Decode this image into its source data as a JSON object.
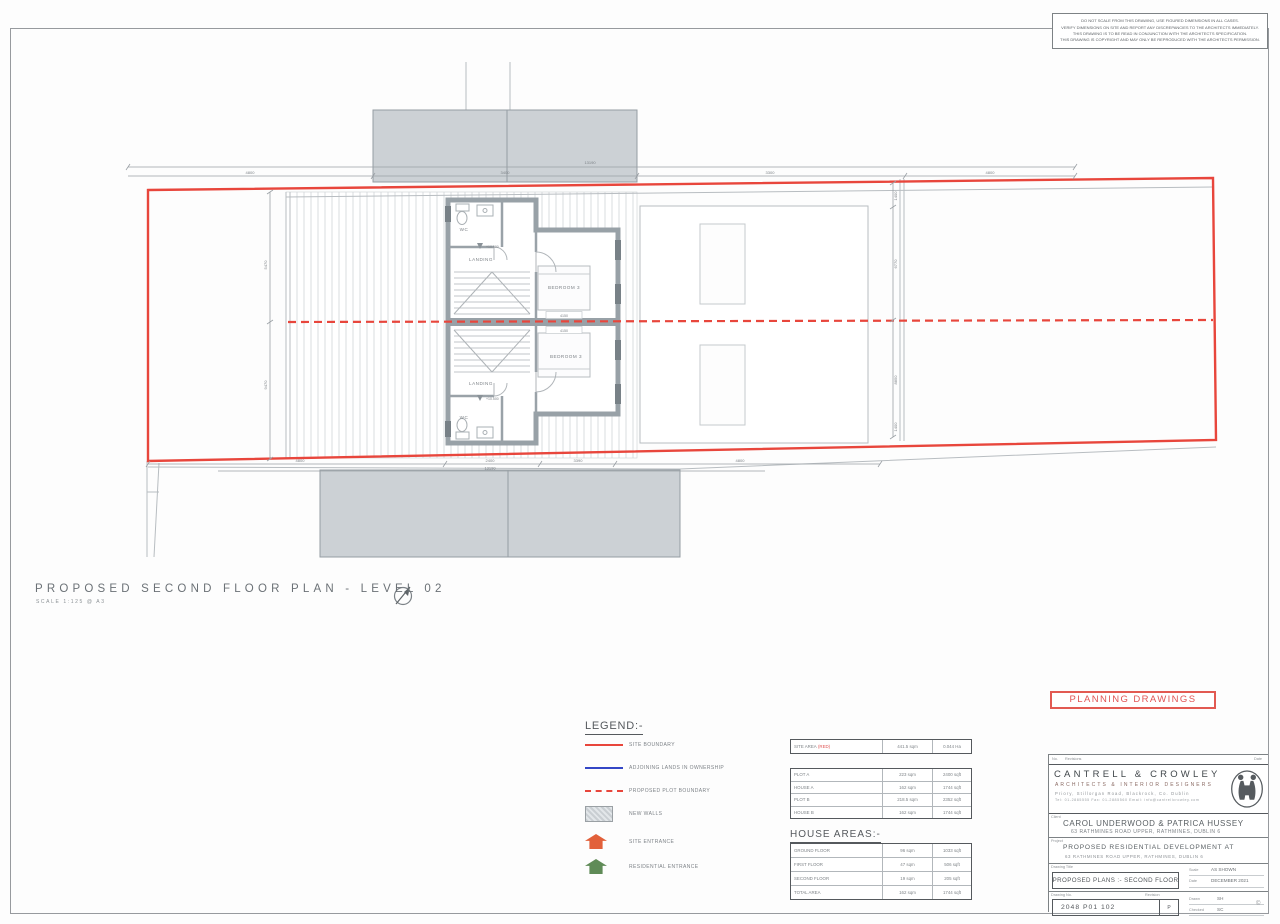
{
  "disclaimer": {
    "line1": "DO NOT SCALE FROM THIS DRAWING, USE FIGURED DIMENSIONS IN ALL CASES.",
    "line2": "VERIFY DIMENSIONS ON SITE AND REPORT ANY DISCREPANCIES TO THE ARCHITECTS IMMEDIATELY.",
    "line3": "THIS DRAWING IS TO BE READ IN CONJUNCTION WITH THE ARCHITECTS SPECIFICATION.",
    "line4": "THIS DRAWING IS COPYRIGHT AND MAY ONLY BE REPRODUCED WITH THE ARCHITECTS PERMISSION."
  },
  "plan_title": {
    "text": "PROPOSED SECOND FLOOR PLAN - LEVEL 02",
    "scale": "SCALE 1:125 @ A3"
  },
  "plan": {
    "rooms": {
      "wc_top": "WC",
      "landing_top": "LANDING",
      "bedroom_top": "BEDROOM 3",
      "wc_bottom": "WC",
      "landing_bottom": "LANDING",
      "bedroom_bottom": "BEDROOM 3"
    },
    "levels": {
      "top": "+10.500",
      "bottom": "+10.500"
    },
    "dims": {
      "top_total": "13190",
      "top_seg_1": "4800",
      "top_seg_2": "3400",
      "top_seg_3": "3300",
      "top_seg_4": "4800",
      "bottom_total": "13190",
      "bottom_seg_1": "4800",
      "bottom_seg_2": "2400",
      "bottom_seg_3": "3390",
      "bottom_seg_4": "4800",
      "right_1": "1400",
      "right_2": "6770",
      "right_3": "8850",
      "right_4": "1400",
      "left_1": "5470",
      "left_2": "9470",
      "bed_top": "4150",
      "bed_bottom": "4150"
    }
  },
  "legend": {
    "heading": "LEGEND:-",
    "items": [
      {
        "label": "SITE BOUNDARY"
      },
      {
        "label": "ADJOINING LANDS IN OWNERSHIP"
      },
      {
        "label": "PROPOSED PLOT BOUNDARY"
      },
      {
        "label": "NEW WALLS"
      },
      {
        "label": "SITE ENTRANCE"
      },
      {
        "label": "RESIDENTIAL ENTRANCE"
      }
    ]
  },
  "areas": {
    "site": {
      "label": "SITE AREA",
      "label_red": "(RED)",
      "sqm": "441.5 sqm",
      "ha": "0.044 Ha"
    },
    "plots": {
      "rows": [
        {
          "name": "PLOT A",
          "sqm": "223 sqm",
          "sqft": "2400 sqft"
        },
        {
          "name": "HOUSE A",
          "sqm": "162 sqm",
          "sqft": "1744 sqft"
        },
        {
          "name": "PLOT B",
          "sqm": "218.5 sqm",
          "sqft": "2352 sqft"
        },
        {
          "name": "HOUSE B",
          "sqm": "162 sqm",
          "sqft": "1744 sqft"
        }
      ]
    },
    "house": {
      "heading": "HOUSE AREAS:-",
      "rows": [
        {
          "name": "GROUND FLOOR",
          "sqm": "96 sqm",
          "sqft": "1033 sqft"
        },
        {
          "name": "FIRST FLOOR",
          "sqm": "47 sqm",
          "sqft": "506 sqft"
        },
        {
          "name": "SECOND FLOOR",
          "sqm": "19 sqm",
          "sqft": "205 sqft"
        },
        {
          "name": "TOTAL AREA",
          "sqm": "162 sqm",
          "sqft": "1744 sqft"
        }
      ]
    }
  },
  "stamp": {
    "planning": "PLANNING DRAWINGS"
  },
  "title_block": {
    "header": {
      "no": "No.",
      "revisions": "Revisions",
      "date": "Date"
    },
    "architect": {
      "name": "CANTRELL & CROWLEY",
      "subtitle": "ARCHITECTS & INTERIOR DESIGNERS",
      "address": "Priory, Stillorgan Road, Blackrock, Co. Dublin",
      "contact": "Tel: 01-2885555   Fax: 01-2885560   Email: info@cantrellcrowley.com"
    },
    "client": {
      "label": "Client",
      "name": "CAROL UNDERWOOD & PATRICA HUSSEY",
      "address": "63 RATHMINES ROAD UPPER, RATHMINES, DUBLIN 6"
    },
    "project": {
      "label": "Project",
      "line1": "PROPOSED RESIDENTIAL DEVELOPMENT AT",
      "line2": "63 RATHMINES ROAD UPPER, RATHMINES, DUBLIN 6"
    },
    "drawing": {
      "title_label": "Drawing Title",
      "title": "PROPOSED PLANS :- SECOND FLOOR",
      "scale_label": "Scale",
      "scale": "AS SHOWN",
      "date_label": "Date",
      "date": "DECEMBER 2021",
      "number_label": "Drawing No.",
      "number": "2048 P01 102",
      "revision_label": "Revision",
      "revision": "P",
      "drawn_label": "Drawn",
      "drawn": "SH",
      "checked_label": "Checked",
      "checked": "SC"
    },
    "copyright": "©"
  }
}
